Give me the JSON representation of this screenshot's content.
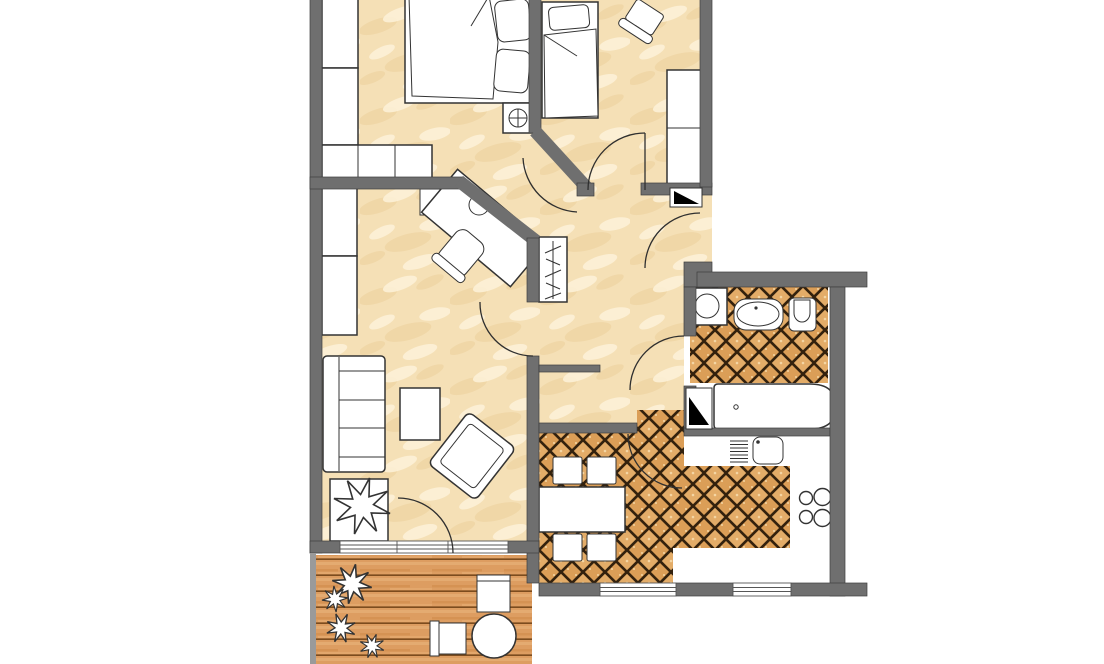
{
  "title": "Two-bedroom apartment floor plan with balcony",
  "palette": {
    "wall": "#6f6f6f",
    "wall_edge": "#3e3e3e",
    "sand": "#f5e0b6",
    "sand_light": "#fdf2da",
    "sand_dark": "#eccf9b",
    "tile": "#e3ac68",
    "tile_alt": "#db9e57",
    "tile_grout": "#33210d",
    "tile_speckle": "#f4d6a4",
    "deck": "#dd9d61",
    "deck_line": "#7c4c1e",
    "deck_light": "#ecb981",
    "deck_dark": "#c9813f",
    "outline": "#333333",
    "furniture_fill": "#ffffff",
    "shaft": "#000000",
    "exterior": "#ffffff"
  },
  "rooms": [
    {
      "name": "bedroom-1",
      "position": "top-left",
      "floor": "sand-screed",
      "furniture": [
        "double-bed",
        "pillow",
        "pillow",
        "nightstand",
        "table-lamp",
        "wardrobe",
        "wardrobe",
        "dresser"
      ]
    },
    {
      "name": "bedroom-2",
      "position": "top-right",
      "floor": "sand-screed",
      "furniture": [
        "single-bed",
        "pillow",
        "side-chair",
        "wardrobe",
        "ventilation-shaft"
      ]
    },
    {
      "name": "living-room",
      "position": "middle-left",
      "floor": "sand-screed",
      "furniture": [
        "shelf-unit",
        "shelf-unit",
        "sofa-3-seat",
        "coffee-table",
        "armchair",
        "corner-desk",
        "desk-lamp",
        "desk-chair",
        "potted-plant-on-stand"
      ]
    },
    {
      "name": "hallway",
      "position": "center",
      "floor": "sand-screed",
      "furniture": [
        "coat-rack-with-hangers"
      ],
      "doors": [
        "entrance-door",
        "bedroom-1-door",
        "bedroom-2-door",
        "living-room-door",
        "bathroom-door",
        "kitchen-door"
      ]
    },
    {
      "name": "bathroom",
      "position": "right",
      "floor": "ceramic-tile",
      "furniture": [
        "washing-machine",
        "washbasin",
        "toilet",
        "bathtub",
        "ventilation-shaft"
      ]
    },
    {
      "name": "kitchen",
      "position": "bottom-right",
      "floor": "ceramic-tile",
      "furniture": [
        "dining-table",
        "dining-chair",
        "dining-chair",
        "dining-chair",
        "dining-chair",
        "counter-with-sink-drainboard",
        "stove-4-burners"
      ],
      "windows": 2
    },
    {
      "name": "balcony",
      "position": "bottom-left",
      "floor": "wood-deck",
      "furniture": [
        "shrub",
        "shrub",
        "shrub",
        "shrub",
        "balcony-chair",
        "balcony-chair",
        "round-table"
      ]
    }
  ],
  "doors": {
    "swing_arcs": 7,
    "entrance_side": "right"
  },
  "windows": {
    "living_room": 1,
    "kitchen": 2
  },
  "counts": {
    "stove_burners": 4,
    "coat_hangers": 5,
    "sofa_seats": 3,
    "dining_chairs": 4
  }
}
